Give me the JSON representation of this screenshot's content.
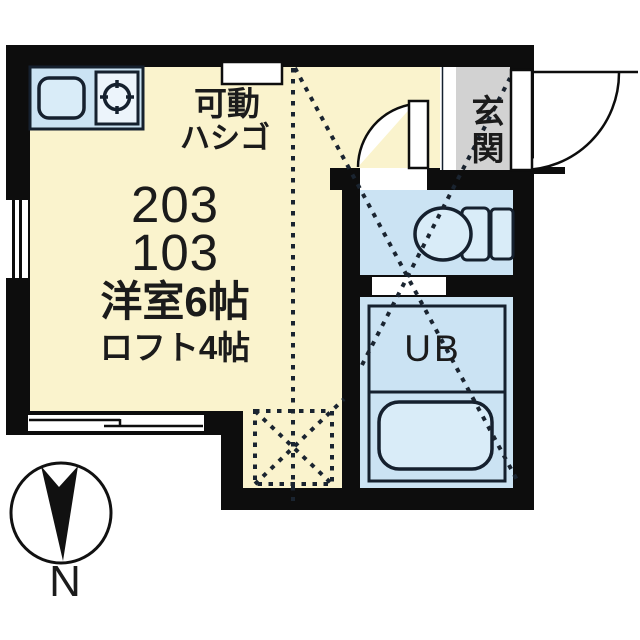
{
  "plan": {
    "type": "apartment floor plan",
    "unit_numbers": [
      "203",
      "103"
    ],
    "main_room_size": "洋室6帖",
    "loft_size": "ロフト4帖",
    "ladder_label_line1": "可動",
    "ladder_label_line2": "ハシゴ",
    "entrance_label": "玄関",
    "unit_bath_label": "UB",
    "compass_label": "N"
  },
  "icons": {
    "kitchen_sink": "rounded-rectangle sink basin",
    "stove_burner": "gas burner circle with ticks",
    "toilet": "toilet bowl with tank",
    "bathtub": "rounded bathtub",
    "north_compass": "circle with dart arrow",
    "swing_doors": "quarter-circle door arcs",
    "loft_outline": "dashed diagonal lines",
    "ladder_position": "dashed crossed box"
  },
  "colors": {
    "wall": "#0d0d0d",
    "main_room": "#faf3cd",
    "wet_area": "#cbe3f3",
    "fixture_fill": "#d9ecf8",
    "entrance_floor": "#d2d2d2",
    "line": "#15202e"
  }
}
